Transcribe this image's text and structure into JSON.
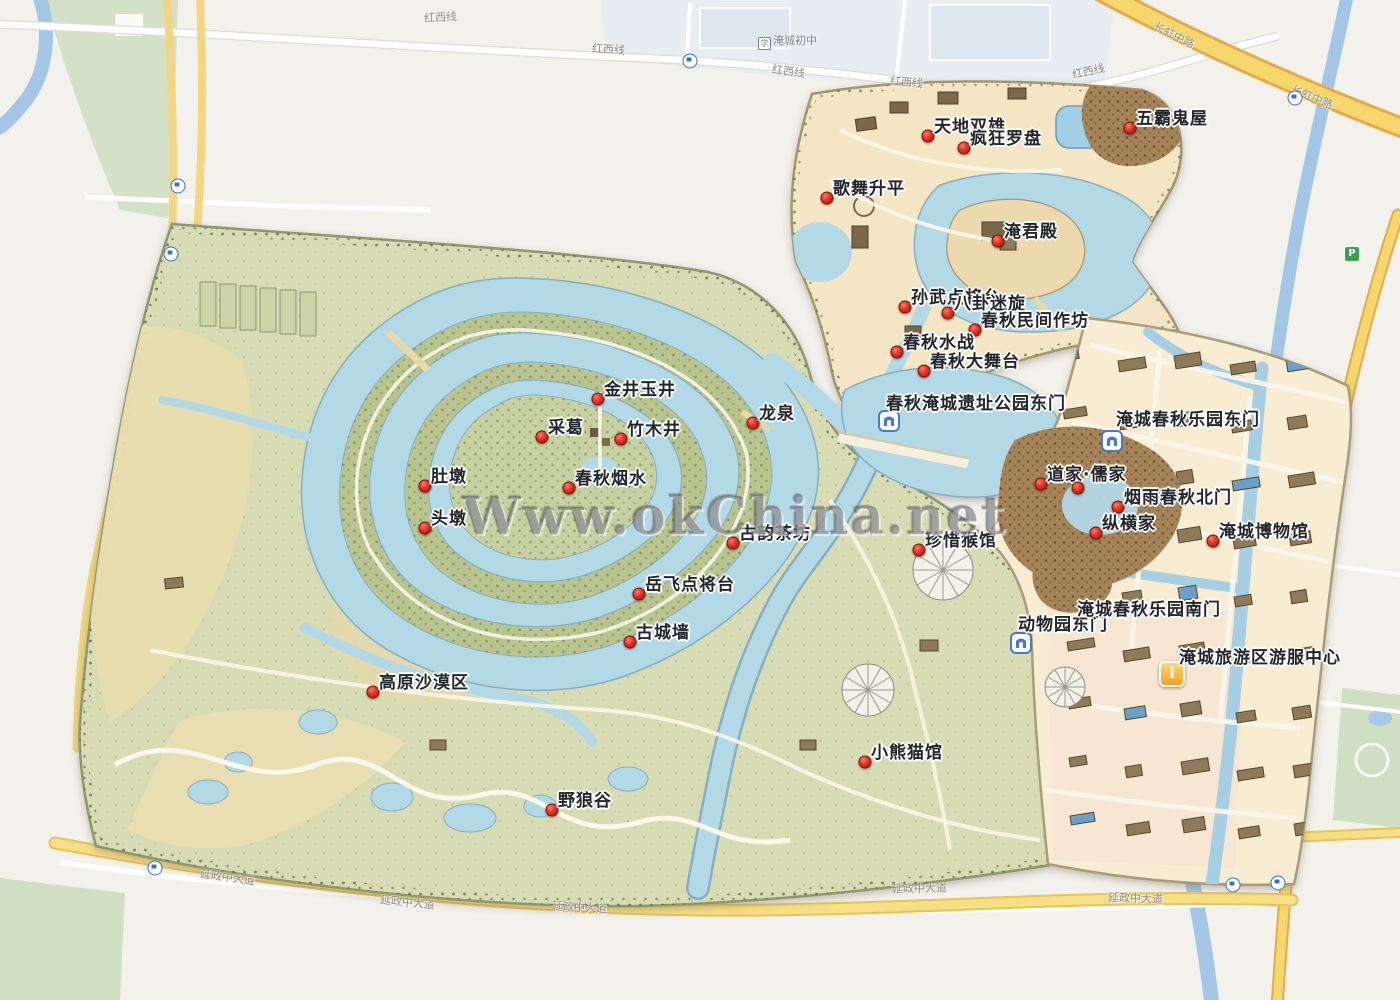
{
  "watermark": "Www.okChina.net",
  "colors": {
    "marker_red": "#e23325",
    "water_blue": "#b3d8e6",
    "park_green": "#d8dcb5",
    "amusement_tan": "#f4e6c4",
    "urban_tan": "#f8ecd2",
    "road_yellow": "#f6d76e",
    "gate_blue": "#4a79c8",
    "info_gold": "#efa023"
  },
  "map": {
    "pois": [
      {
        "label": "天地双雄",
        "x": 928,
        "y": 136
      },
      {
        "label": "疯狂罗盘",
        "x": 964,
        "y": 148
      },
      {
        "label": "五霸鬼屋",
        "x": 1130,
        "y": 128
      },
      {
        "label": "歌舞升平",
        "x": 827,
        "y": 198
      },
      {
        "label": "淹君殿",
        "x": 998,
        "y": 241
      },
      {
        "label": "孙武点将台",
        "x": 905,
        "y": 307
      },
      {
        "label": "八卦迷旋",
        "x": 948,
        "y": 313
      },
      {
        "label": "春秋民间作坊",
        "x": 975,
        "y": 330
      },
      {
        "label": "春秋水战",
        "x": 897,
        "y": 352
      },
      {
        "label": "春秋大舞台",
        "x": 924,
        "y": 371
      },
      {
        "label": "金井玉井",
        "x": 598,
        "y": 399
      },
      {
        "label": "采葛",
        "x": 542,
        "y": 437
      },
      {
        "label": "竹木井",
        "x": 621,
        "y": 439
      },
      {
        "label": "龙泉",
        "x": 753,
        "y": 423
      },
      {
        "label": "春秋烟水",
        "x": 569,
        "y": 488
      },
      {
        "label": "肚墩",
        "x": 425,
        "y": 486
      },
      {
        "label": "头墩",
        "x": 425,
        "y": 528
      },
      {
        "label": "古韵茶坊",
        "x": 733,
        "y": 543
      },
      {
        "label": "道家·儒家",
        "x": 1041,
        "y": 484
      },
      {
        "label": "烟雨春秋北门",
        "x": 1118,
        "y": 507
      },
      {
        "label": "纵横家",
        "x": 1096,
        "y": 533
      },
      {
        "label": "淹城博物馆",
        "x": 1213,
        "y": 541
      },
      {
        "label": "岳飞点将台",
        "x": 639,
        "y": 594
      },
      {
        "label": "古城墙",
        "x": 630,
        "y": 642
      },
      {
        "label": "珍惜猴馆",
        "x": 919,
        "y": 550
      },
      {
        "label": "小熊猫馆",
        "x": 865,
        "y": 762
      },
      {
        "label": "高原沙漠区",
        "x": 373,
        "y": 692
      },
      {
        "label": "野狼谷",
        "x": 552,
        "y": 810
      }
    ],
    "extra_dots": [
      {
        "x": 1078,
        "y": 488
      }
    ],
    "gates": [
      {
        "label": "春秋淹城遗址公园东门",
        "text_x": 886,
        "text_y": 396,
        "icon_x": 889,
        "icon_y": 421,
        "has_icon": true
      },
      {
        "label": "淹城春秋乐园东门",
        "text_x": 1116,
        "text_y": 412,
        "icon_x": 1112,
        "icon_y": 441,
        "has_icon": true
      },
      {
        "label": "动物园东门",
        "text_x": 1018,
        "text_y": 617,
        "icon_x": 1021,
        "icon_y": 643,
        "has_icon": true
      },
      {
        "label": "淹城春秋乐园南门",
        "text_x": 1077,
        "text_y": 602,
        "has_icon": false
      }
    ],
    "info_center": {
      "label": "淹城旅游区游服中心",
      "text_x": 1179,
      "text_y": 650,
      "icon_x": 1172,
      "icon_y": 674
    },
    "road_labels": [
      {
        "text": "红西线",
        "x": 424,
        "y": 12,
        "angle": -3
      },
      {
        "text": "红西线",
        "x": 592,
        "y": 44,
        "angle": 4
      },
      {
        "text": "红西线",
        "x": 772,
        "y": 66,
        "angle": 8
      },
      {
        "text": "红西线",
        "x": 890,
        "y": 77,
        "angle": 6
      },
      {
        "text": "红西线",
        "x": 1072,
        "y": 66,
        "angle": -12
      },
      {
        "text": "延政中大道",
        "x": 200,
        "y": 872,
        "angle": 8
      },
      {
        "text": "延政中大道",
        "x": 380,
        "y": 897,
        "angle": 6
      },
      {
        "text": "延政中大道",
        "x": 552,
        "y": 902,
        "angle": 3
      },
      {
        "text": "延政中大道",
        "x": 892,
        "y": 883,
        "angle": -1
      },
      {
        "text": "延政中大道",
        "x": 1108,
        "y": 893,
        "angle": 2
      },
      {
        "text": "长虹中路",
        "x": 1152,
        "y": 30,
        "angle": 26
      },
      {
        "text": "长虹中路",
        "x": 1290,
        "y": 92,
        "angle": 22
      }
    ],
    "place_labels": [
      {
        "text": "淹城初中",
        "x": 758,
        "y": 35
      }
    ],
    "bus_stops": [
      {
        "x": 690,
        "y": 61
      },
      {
        "x": 178,
        "y": 186
      },
      {
        "x": 171,
        "y": 254
      },
      {
        "x": 155,
        "y": 868
      },
      {
        "x": 1295,
        "y": 98
      },
      {
        "x": 1233,
        "y": 885
      },
      {
        "x": 1278,
        "y": 883
      }
    ],
    "parking": [
      {
        "x": 1352,
        "y": 254
      }
    ]
  }
}
